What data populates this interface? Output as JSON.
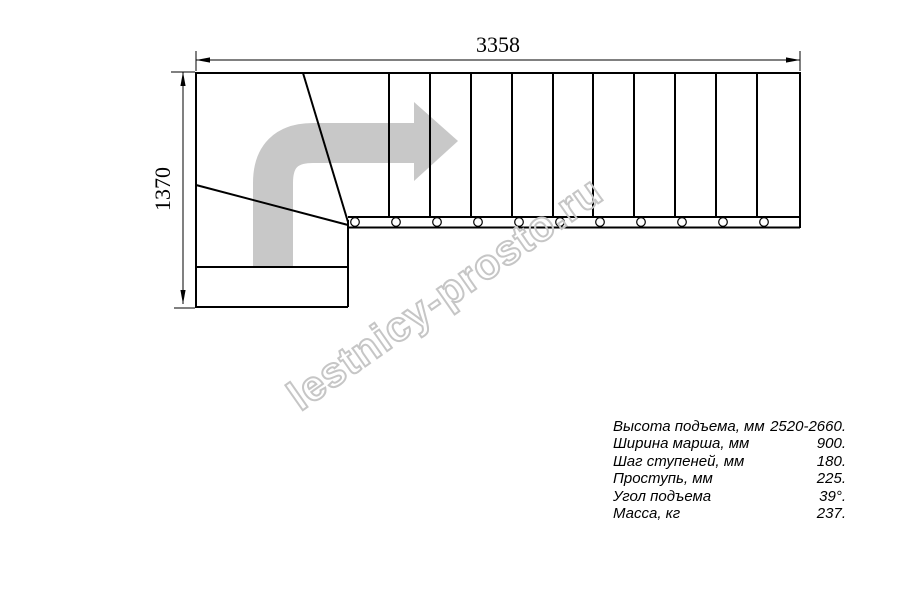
{
  "drawing": {
    "type": "staircase-plan-top-view",
    "top_dimension": "3358",
    "left_dimension": "1370",
    "watermark": "lestnicy-prosto.ru",
    "straight_flight_steps": 11,
    "winder_steps": 3,
    "colors": {
      "line": "#000000",
      "arrow_gray": "#c8c8c8",
      "watermark_gray": "#c6c6c6"
    }
  },
  "specs": {
    "rows": [
      {
        "label": "Высота подъема, мм",
        "value": "2520-2660."
      },
      {
        "label": "Ширина марша, мм",
        "value": "900."
      },
      {
        "label": "Шаг ступеней, мм",
        "value": "180."
      },
      {
        "label": "Проступь, мм",
        "value": "225."
      },
      {
        "label": "Угол подъема",
        "value": "39°."
      },
      {
        "label": "Масса, кг",
        "value": "237."
      }
    ]
  }
}
